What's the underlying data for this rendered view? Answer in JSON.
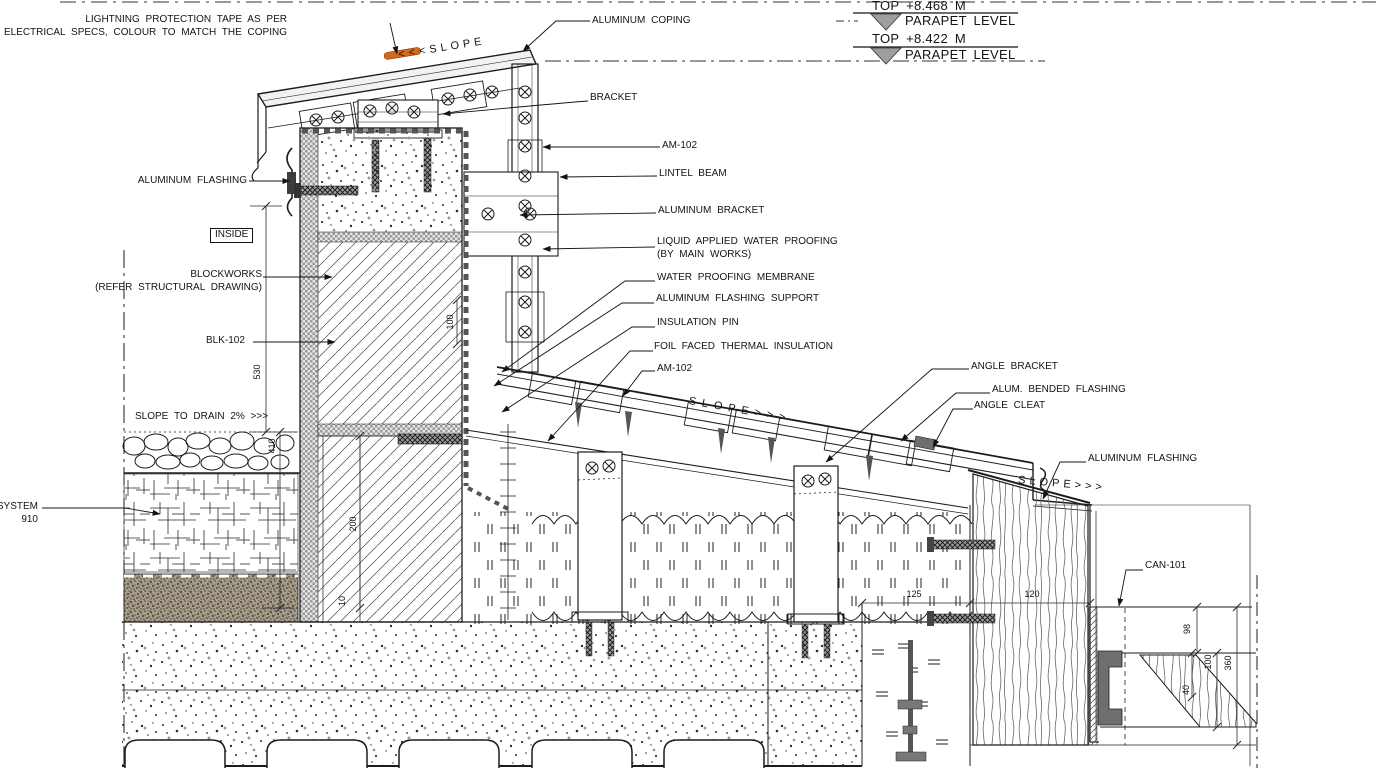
{
  "drawing": {
    "levels": {
      "l1_title": "TOP +8.468 M",
      "l1_sub": "PARAPET LEVEL",
      "l2_title": "TOP +8.422 M",
      "l2_sub": "PARAPET LEVEL"
    },
    "slopes": {
      "coping": "<<<SLOPE",
      "roof": "SLOPE>>>",
      "canopy": "SLOPE>>>",
      "drain": "SLOPE TO DRAIN 2% >>>"
    },
    "callouts": {
      "lightning_1": "LIGHTNING PROTECTION TAPE AS PER",
      "lightning_2": "ELECTRICAL SPECS, COLOUR TO MATCH THE COPING",
      "aluminum_coping": "ALUMINUM COPING",
      "bracket": "BRACKET",
      "am_102_upper": "AM-102",
      "lintel_beam": "LINTEL BEAM",
      "aluminum_bracket": "ALUMINUM BRACKET",
      "liquid_1": "LIQUID APPLIED WATER PROOFING",
      "liquid_2": "(BY MAIN WORKS)",
      "water_proofing_membrane": "WATER PROOFING MEMBRANE",
      "aluminum_flashing_support": "ALUMINUM FLASHING SUPPORT",
      "insulation_pin": "INSULATION PIN",
      "foil_faced": "FOIL FACED THERMAL INSULATION",
      "am_102_lower": "AM-102",
      "angle_bracket": "ANGLE BRACKET",
      "alum_bended_flashing": "ALUM. BENDED FLASHING",
      "angle_cleat": "ANGLE CLEAT",
      "aluminum_flashing_right": "ALUMINUM FLASHING",
      "can_101": "CAN-101",
      "aluminum_flashing_left": "ALUMINUM FLASHING",
      "inside": "INSIDE",
      "blockworks_1": "BLOCKWORKS",
      "blockworks_2": "(REFER STRUCTURAL DRAWING)",
      "blk_102": "BLK-102",
      "system_1": "SYSTEM",
      "system_2": "910"
    },
    "dimensions": {
      "wall_height": "530",
      "green_depth": "410",
      "block": "200",
      "block_small": "10",
      "membrane": "100",
      "deck_left": "125",
      "deck_right": "120",
      "canopy_a": "98",
      "canopy_b": "100",
      "canopy_c": "360",
      "canopy_d": "40"
    },
    "colors": {
      "line": "#222222",
      "tape": "#d2691e",
      "level_marker": "#9e9e9e",
      "dark_metal": "#6e6e6e"
    }
  }
}
